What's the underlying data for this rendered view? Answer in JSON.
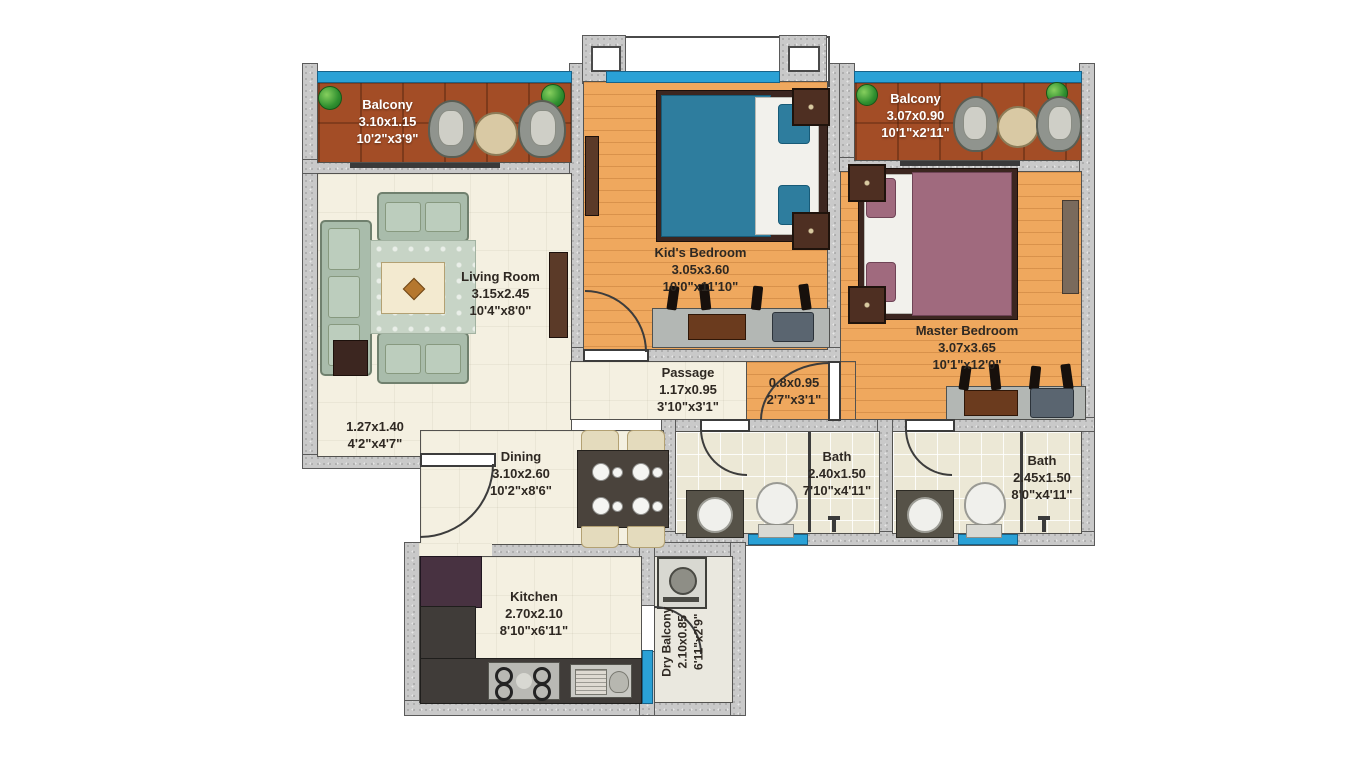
{
  "rooms": {
    "balcony_left": {
      "name": "Balcony",
      "metric": "3.10x1.15",
      "imperial": "10'2\"x3'9\""
    },
    "balcony_right": {
      "name": "Balcony",
      "metric": "3.07x0.90",
      "imperial": "10'1\"x2'11\""
    },
    "living_room": {
      "name": "Living Room",
      "metric": "3.15x2.45",
      "imperial": "10'4\"x8'0\""
    },
    "kids_bedroom": {
      "name": "Kid's Bedroom",
      "metric": "3.05x3.60",
      "imperial": "10'0\"x11'10\""
    },
    "master_bedroom": {
      "name": "Master Bedroom",
      "metric": "3.07x3.65",
      "imperial": "10'1\"x12'0\""
    },
    "passage": {
      "name": "Passage",
      "metric": "1.17x0.95",
      "imperial": "3'10\"x3'1\""
    },
    "lobby": {
      "metric": "0.8x0.95",
      "imperial": "2'7\"x3'1\""
    },
    "foyer": {
      "metric": "1.27x1.40",
      "imperial": "4'2\"x4'7\""
    },
    "dining": {
      "name": "Dining",
      "metric": "3.10x2.60",
      "imperial": "10'2\"x8'6\""
    },
    "bath_1": {
      "name": "Bath",
      "metric": "2.40x1.50",
      "imperial": "7'10\"x4'11\""
    },
    "bath_2": {
      "name": "Bath",
      "metric": "2.45x1.50",
      "imperial": "8'0\"x4'11\""
    },
    "kitchen": {
      "name": "Kitchen",
      "metric": "2.70x2.10",
      "imperial": "8'10\"x6'11\""
    },
    "dry_balcony": {
      "name": "Dry Balcony",
      "metric": "2.10x0.85",
      "imperial": "6'11\"x2'9\""
    }
  },
  "colors": {
    "window_blue": "#2aa1d6",
    "balcony_floor": "#a34d26",
    "bedroom_wood": "#efa85e",
    "living_floor": "#f4f0e1",
    "wall_gray": "#c9c9c9",
    "label_dark": "#2e2822",
    "label_light": "#ffffff"
  }
}
